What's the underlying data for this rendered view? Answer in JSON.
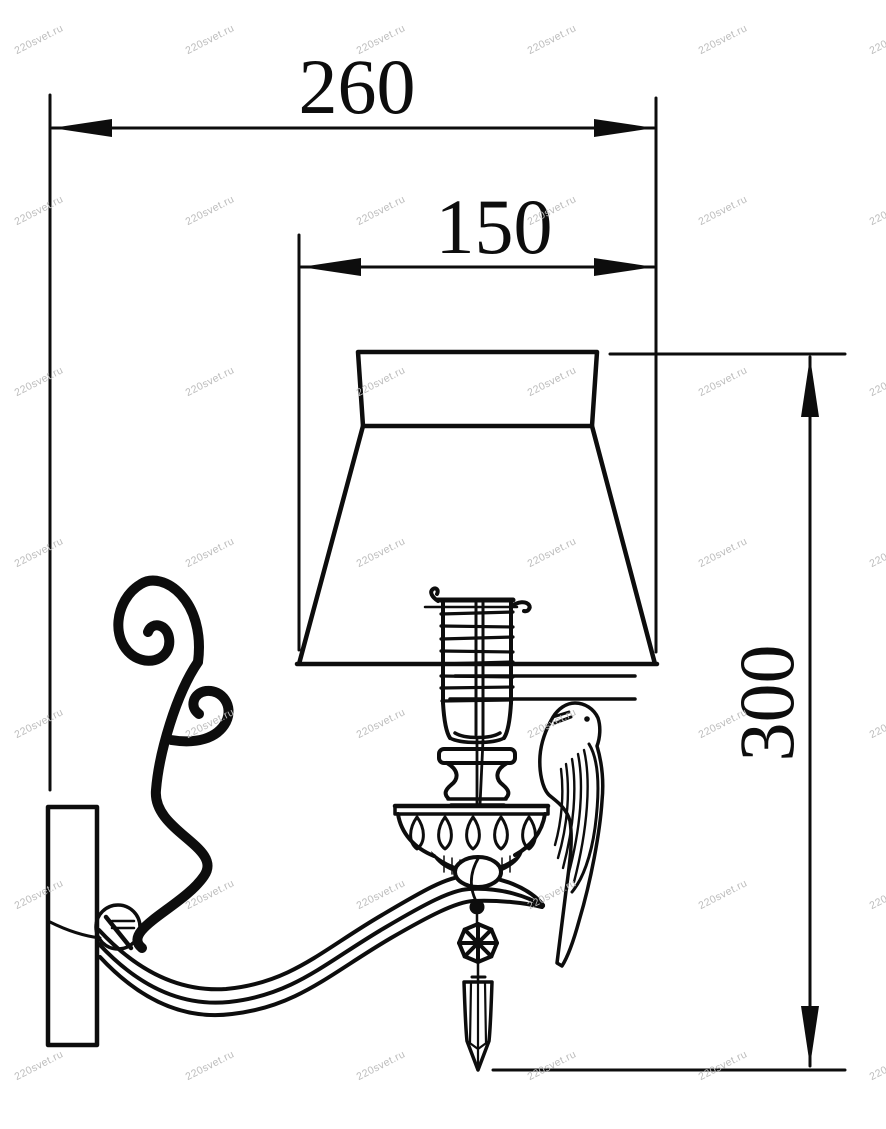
{
  "drawing": {
    "type": "technical-dimension-drawing",
    "dimensions": {
      "overall_width": "260",
      "shade_width": "150",
      "height": "300"
    },
    "watermark": {
      "text": "220svet.ru",
      "color": "#bcbcbc",
      "grid": {
        "cols": 6,
        "rows": 7
      }
    },
    "colors": {
      "line": "#0d0d0d",
      "background": "#ffffff",
      "shade_rim_gray": "#9a9a9a"
    }
  }
}
